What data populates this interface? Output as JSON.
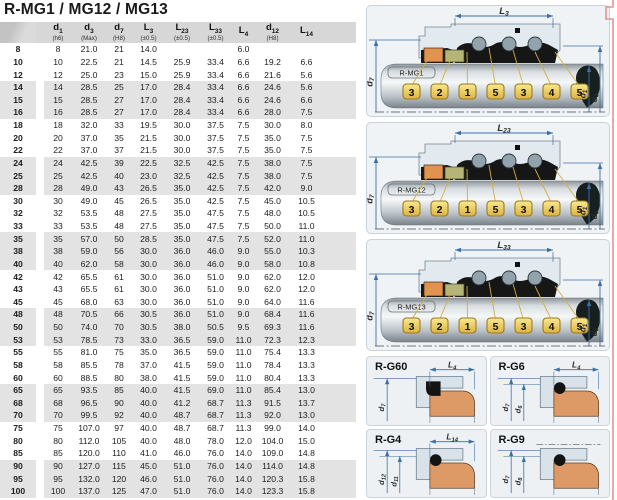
{
  "title": "R-MG1 / MG12 / MG13",
  "colors": {
    "dim_blue": "#3a6fa8",
    "tag_fill_top": "#f9e98f",
    "tag_fill_bottom": "#ddb33f",
    "tag_border": "#9c7b1e",
    "leader_yellow": "#cfae45",
    "component_orange": "#e2914f",
    "component_olive": "#b5b578",
    "seat_orange": "#dd9a66",
    "band_gray": "#e3e3e3",
    "header_gray": "#d7d7d7",
    "panel_bg": "#f0f3f6",
    "panel_border": "#c9d2da",
    "red_edge": "#e09595"
  },
  "table": {
    "columns": [
      {
        "sym": "",
        "sub": "",
        "note": ""
      },
      {
        "sym": "d",
        "sub": "1",
        "note": "(h6)"
      },
      {
        "sym": "d",
        "sub": "3",
        "note": "(Max)"
      },
      {
        "sym": "d",
        "sub": "7",
        "note": "(H8)"
      },
      {
        "sym": "L",
        "sub": "3",
        "note": "(±0.5)"
      },
      {
        "sym": "L",
        "sub": "23",
        "note": "(±0.5)"
      },
      {
        "sym": "L",
        "sub": "33",
        "note": "(±0.5)"
      },
      {
        "sym": "L",
        "sub": "4",
        "note": ""
      },
      {
        "sym": "d",
        "sub": "12",
        "note": "(H8)"
      },
      {
        "sym": "L",
        "sub": "14",
        "note": ""
      }
    ],
    "rows": [
      [
        "8",
        "8",
        "21.0",
        "21",
        "14.0",
        "",
        "",
        "6.0",
        "",
        ""
      ],
      [
        "10",
        "10",
        "22.5",
        "21",
        "14.5",
        "25.9",
        "33.4",
        "6.6",
        "19.2",
        "6.6"
      ],
      [
        "12",
        "12",
        "25.0",
        "23",
        "15.0",
        "25.9",
        "33.4",
        "6.6",
        "21.6",
        "5.6"
      ],
      [
        "14",
        "14",
        "28.5",
        "25",
        "17.0",
        "28.4",
        "33.4",
        "6.6",
        "24.6",
        "5.6"
      ],
      [
        "15",
        "15",
        "28.5",
        "27",
        "17.0",
        "28.4",
        "33.4",
        "6.6",
        "24.6",
        "6.6"
      ],
      [
        "16",
        "16",
        "28.5",
        "27",
        "17.0",
        "28.4",
        "33.4",
        "6.6",
        "28.0",
        "7.5"
      ],
      [
        "18",
        "18",
        "32.0",
        "33",
        "19.5",
        "30.0",
        "37.5",
        "7.5",
        "30.0",
        "8.0"
      ],
      [
        "20",
        "20",
        "37.0",
        "35",
        "21.5",
        "30.0",
        "37.5",
        "7.5",
        "35.0",
        "7.5"
      ],
      [
        "22",
        "22",
        "37.0",
        "37",
        "21.5",
        "30.0",
        "37.5",
        "7.5",
        "35.0",
        "7.5"
      ],
      [
        "24",
        "24",
        "42.5",
        "39",
        "22.5",
        "32.5",
        "42.5",
        "7.5",
        "38.0",
        "7.5"
      ],
      [
        "25",
        "25",
        "42.5",
        "40",
        "23.0",
        "32.5",
        "42.5",
        "7.5",
        "38.0",
        "7.5"
      ],
      [
        "28",
        "28",
        "49.0",
        "43",
        "26.5",
        "35.0",
        "42.5",
        "7.5",
        "42.0",
        "9.0"
      ],
      [
        "30",
        "30",
        "49.0",
        "45",
        "26.5",
        "35.0",
        "42.5",
        "7.5",
        "45.0",
        "10.5"
      ],
      [
        "32",
        "32",
        "53.5",
        "48",
        "27.5",
        "35.0",
        "47.5",
        "7.5",
        "48.0",
        "10.5"
      ],
      [
        "33",
        "33",
        "53.5",
        "48",
        "27.5",
        "35.0",
        "47.5",
        "7.5",
        "50.0",
        "11.0"
      ],
      [
        "35",
        "35",
        "57.0",
        "50",
        "28.5",
        "35.0",
        "47.5",
        "7.5",
        "52.0",
        "11.0"
      ],
      [
        "38",
        "38",
        "59.0",
        "56",
        "30.0",
        "36.0",
        "46.0",
        "9.0",
        "55.0",
        "10.3"
      ],
      [
        "40",
        "40",
        "62.0",
        "58",
        "30.0",
        "36.0",
        "46.0",
        "9.0",
        "58.0",
        "10.8"
      ],
      [
        "42",
        "42",
        "65.5",
        "61",
        "30.0",
        "36.0",
        "51.0",
        "9.0",
        "62.0",
        "12.0"
      ],
      [
        "43",
        "43",
        "65.5",
        "61",
        "30.0",
        "36.0",
        "51.0",
        "9.0",
        "62.0",
        "12.0"
      ],
      [
        "45",
        "45",
        "68.0",
        "63",
        "30.0",
        "36.0",
        "51.0",
        "9.0",
        "64.0",
        "11.6"
      ],
      [
        "48",
        "48",
        "70.5",
        "66",
        "30.5",
        "36.0",
        "51.0",
        "9.0",
        "68.4",
        "11.6"
      ],
      [
        "50",
        "50",
        "74.0",
        "70",
        "30.5",
        "38.0",
        "50.5",
        "9.5",
        "69.3",
        "11.6"
      ],
      [
        "53",
        "53",
        "78.5",
        "73",
        "33.0",
        "36.5",
        "59.0",
        "11.0",
        "72.3",
        "12.3"
      ],
      [
        "55",
        "55",
        "81.0",
        "75",
        "35.0",
        "36.5",
        "59.0",
        "11.0",
        "75.4",
        "13.3"
      ],
      [
        "58",
        "58",
        "85.5",
        "78",
        "37.0",
        "41.5",
        "59.0",
        "11.0",
        "78.4",
        "13.3"
      ],
      [
        "60",
        "60",
        "88.5",
        "80",
        "38.0",
        "41.5",
        "59.0",
        "11.0",
        "80.4",
        "13.3"
      ],
      [
        "65",
        "65",
        "93.5",
        "85",
        "40.0",
        "41.5",
        "69.0",
        "11.0",
        "85.4",
        "13.0"
      ],
      [
        "68",
        "68",
        "96.5",
        "90",
        "40.0",
        "41.2",
        "68.7",
        "11.3",
        "91.5",
        "13.7"
      ],
      [
        "70",
        "70",
        "99.5",
        "92",
        "40.0",
        "48.7",
        "68.7",
        "11.3",
        "92.0",
        "13.0"
      ],
      [
        "75",
        "75",
        "107.0",
        "97",
        "40.0",
        "48.7",
        "68.7",
        "11.3",
        "99.0",
        "14.0"
      ],
      [
        "80",
        "80",
        "112.0",
        "105",
        "40.0",
        "48.0",
        "78.0",
        "12.0",
        "104.0",
        "15.0"
      ],
      [
        "85",
        "85",
        "120.0",
        "110",
        "41.0",
        "46.0",
        "76.0",
        "14.0",
        "109.0",
        "14.8"
      ],
      [
        "90",
        "90",
        "127.0",
        "115",
        "45.0",
        "51.0",
        "76.0",
        "14.0",
        "114.0",
        "14.8"
      ],
      [
        "95",
        "95",
        "132.0",
        "120",
        "46.0",
        "51.0",
        "76.0",
        "14.0",
        "120.3",
        "15.8"
      ],
      [
        "100",
        "100",
        "137.0",
        "125",
        "47.0",
        "51.0",
        "76.0",
        "14.0",
        "123.3",
        "15.8"
      ]
    ]
  },
  "diagrams": [
    {
      "name": "R-MG1",
      "top_dim": {
        "sym": "L",
        "sub": "3"
      },
      "left_dim": {
        "sym": "d",
        "sub": "7"
      },
      "right_dims": [
        {
          "sym": "d",
          "sub": "1"
        },
        {
          "sym": "d",
          "sub": "3"
        }
      ],
      "tags": [
        "3",
        "2",
        "1",
        "5",
        "3",
        "4",
        "5"
      ]
    },
    {
      "name": "R-MG12",
      "top_dim": {
        "sym": "L",
        "sub": "23"
      },
      "left_dim": {
        "sym": "d",
        "sub": "7"
      },
      "right_dims": [
        {
          "sym": "d",
          "sub": "1"
        },
        {
          "sym": "d",
          "sub": "3"
        }
      ],
      "tags": [
        "3",
        "2",
        "1",
        "5",
        "3",
        "4",
        "5"
      ]
    },
    {
      "name": "R-MG13",
      "top_dim": {
        "sym": "L",
        "sub": "33"
      },
      "left_dim": {
        "sym": "d",
        "sub": "7"
      },
      "right_dims": [
        {
          "sym": "d",
          "sub": "1"
        },
        {
          "sym": "d",
          "sub": "3"
        }
      ],
      "tags": [
        "3",
        "2",
        "1",
        "5",
        "3",
        "4",
        "5"
      ]
    }
  ],
  "seats": [
    {
      "name": "R-G60",
      "top_dim": {
        "sym": "L",
        "sub": "4"
      },
      "left_dims": [
        {
          "sym": "d",
          "sub": "7"
        }
      ],
      "cup": true
    },
    {
      "name": "R-G6",
      "top_dim": {
        "sym": "L",
        "sub": "4"
      },
      "left_dims": [
        {
          "sym": "d",
          "sub": "7"
        },
        {
          "sym": "d",
          "sub": "6"
        }
      ]
    },
    {
      "name": "R-G4",
      "top_dim": {
        "sym": "L",
        "sub": "14"
      },
      "left_dims": [
        {
          "sym": "d",
          "sub": "12"
        },
        {
          "sym": "d",
          "sub": "11"
        }
      ]
    },
    {
      "name": "R-G9",
      "top_dim": null,
      "left_dims": [
        {
          "sym": "d",
          "sub": "7"
        },
        {
          "sym": "d",
          "sub": "8"
        }
      ]
    }
  ]
}
